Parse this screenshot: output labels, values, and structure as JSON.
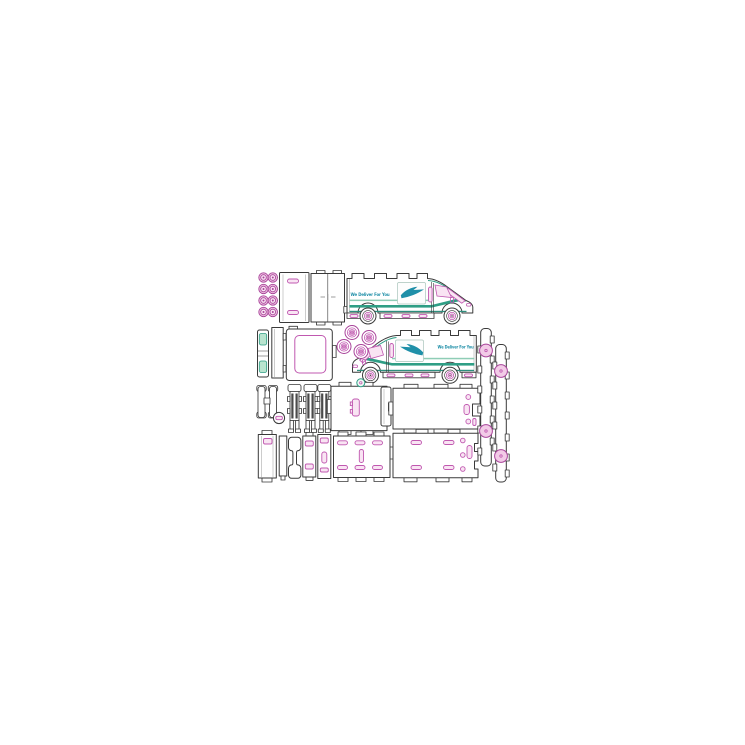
{
  "meta": {
    "description": "Laser-cut model kit parts sheet for a postal delivery van"
  },
  "vans": {
    "slogan": "We Deliver For You"
  },
  "parts": {
    "wheel_hub_washers": 8,
    "loose_wheels": 4,
    "van_side_profiles": 2,
    "wheels_on_vans": 4,
    "door_panels": 3,
    "axle_comb_brackets": 3,
    "floor_and_body_panels": 4,
    "bumper_zigzag_strips": 2
  },
  "colors": {
    "outline": "#3a3a3a",
    "magenta": "#c058b0",
    "magenta_dark": "#a8439a",
    "pink_fill": "#f2cbe7",
    "pink_light": "#f9e4f3",
    "teal": "#2f9e85",
    "teal_light": "#8fcdb6",
    "teal_dark": "#2e8f7e",
    "teal_text": "#1f8fa8",
    "comb_dark": "#4a4a4a",
    "logo_border": "#a9c4bb",
    "paper": "#ffffff"
  }
}
